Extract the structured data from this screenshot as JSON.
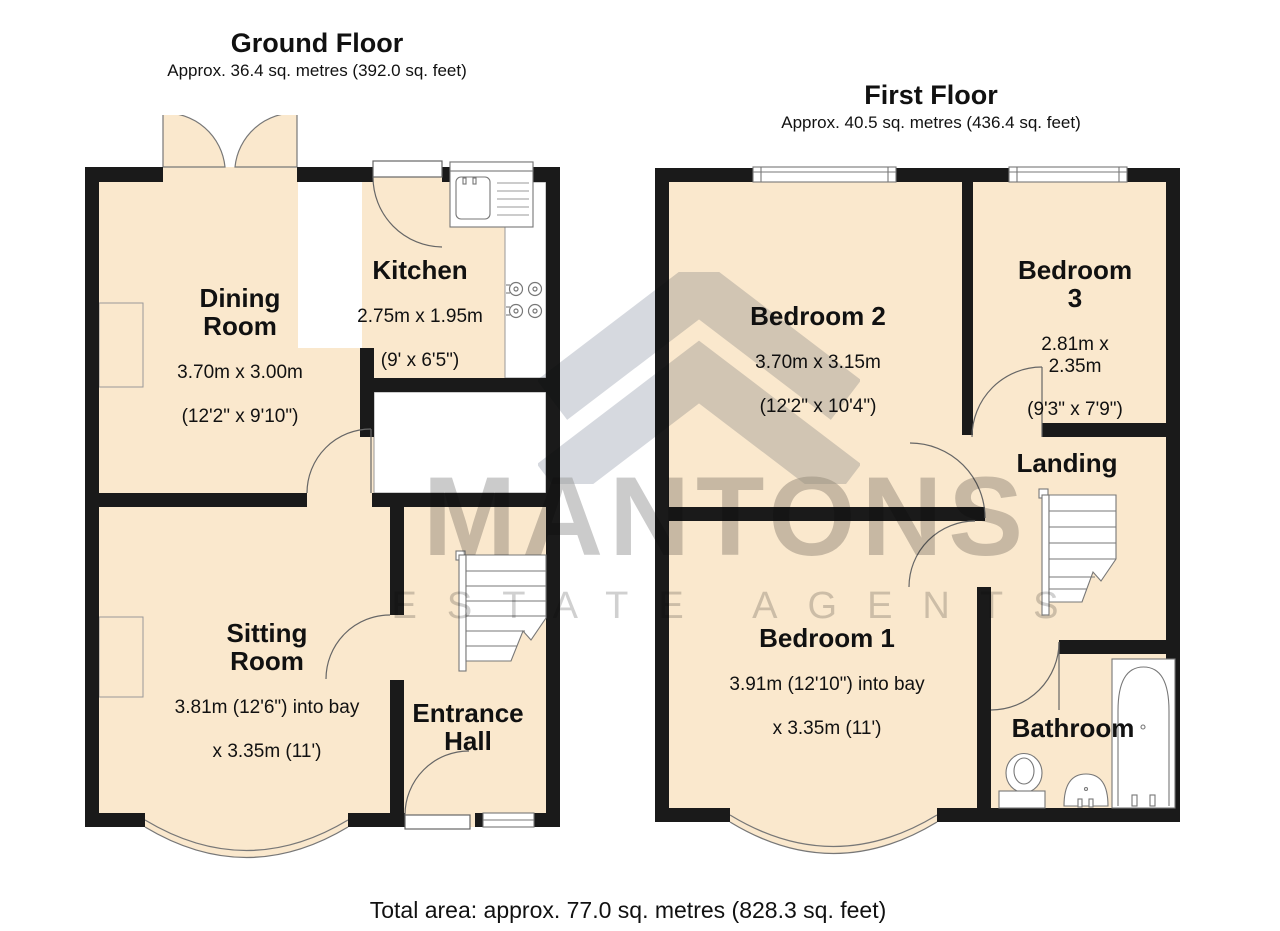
{
  "ground": {
    "title": "Ground Floor",
    "subtitle": "Approx. 36.4 sq. metres (392.0 sq. feet)",
    "rooms": {
      "dining": {
        "name": "Dining\nRoom",
        "dim1": "3.70m x 3.00m",
        "dim2": "(12'2\" x 9'10\")"
      },
      "kitchen": {
        "name": "Kitchen",
        "dim1": "2.75m x 1.95m",
        "dim2": "(9' x 6'5\")"
      },
      "sitting": {
        "name": "Sitting\nRoom",
        "dim1": "3.81m (12'6\") into bay",
        "dim2": "x 3.35m (11')"
      },
      "hall": {
        "name": "Entrance\nHall"
      }
    }
  },
  "first": {
    "title": "First Floor",
    "subtitle": "Approx. 40.5 sq. metres (436.4 sq. feet)",
    "rooms": {
      "bedroom2": {
        "name": "Bedroom 2",
        "dim1": "3.70m x 3.15m",
        "dim2": "(12'2\" x 10'4\")"
      },
      "bedroom3": {
        "name": "Bedroom 3",
        "dim1": "2.81m x 2.35m",
        "dim2": "(9'3\" x 7'9\")"
      },
      "landing": {
        "name": "Landing"
      },
      "bedroom1": {
        "name": "Bedroom 1",
        "dim1": "3.91m (12'10\") into bay",
        "dim2": "x 3.35m (11')"
      },
      "bathroom": {
        "name": "Bathroom"
      }
    }
  },
  "watermark": {
    "brand": "MANTONS",
    "tagline": "ESTATE AGENTS"
  },
  "footer": {
    "total": "Total area: approx. 77.0 sq. metres (828.3 sq. feet)"
  },
  "colors": {
    "floor": "#FAE8CD",
    "wall": "#1A1A1A",
    "outline": "#777777"
  }
}
